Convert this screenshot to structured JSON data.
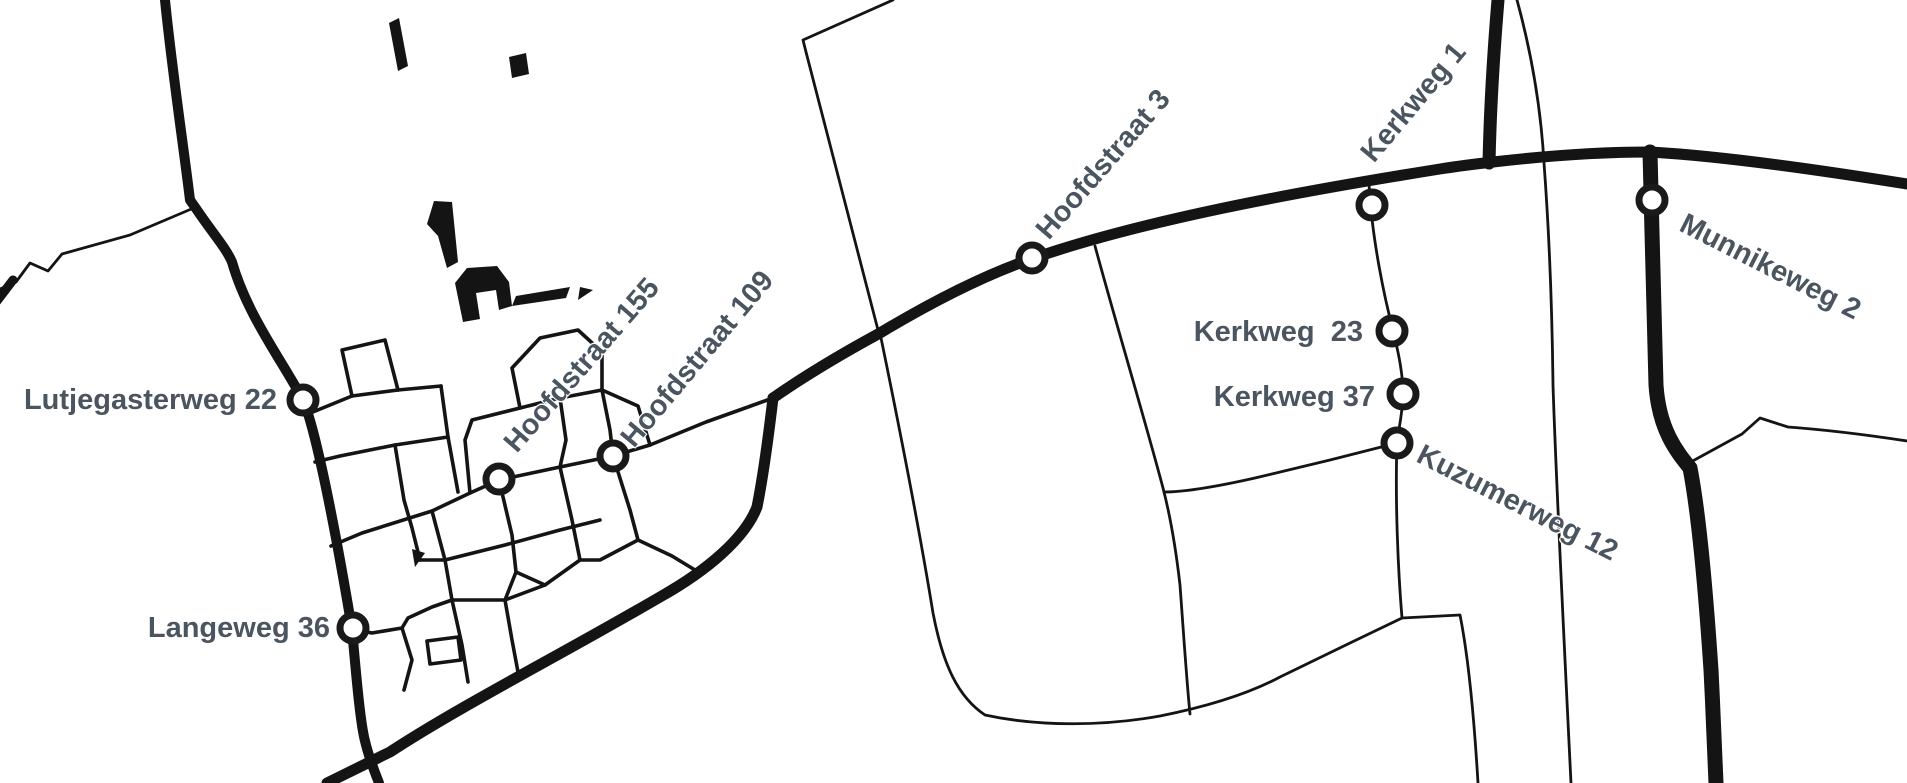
{
  "map": {
    "type": "monochrome-street-map",
    "background": "#ffffff",
    "road_color": "#141414",
    "label_color": "#4a5560",
    "marker_fill": "#ffffff",
    "marker_stroke": "#1a1a1a",
    "markers": [
      {
        "id": "lutjegasterweg-22",
        "label": "Lutjegasterweg 22",
        "x": 303,
        "y": 400,
        "label_rotation_deg": 0
      },
      {
        "id": "langeweg-36",
        "label": "Langeweg 36",
        "x": 353,
        "y": 628,
        "label_rotation_deg": 0
      },
      {
        "id": "hoofdstraat-155",
        "label": "Hoofdstraat 155",
        "x": 499,
        "y": 479,
        "label_rotation_deg": -49
      },
      {
        "id": "hoofdstraat-109",
        "label": "Hoofdstraat 109",
        "x": 613,
        "y": 456,
        "label_rotation_deg": -50
      },
      {
        "id": "hoofdstraat-3",
        "label": "Hoofdstraat 3",
        "x": 1032,
        "y": 258,
        "label_rotation_deg": -49
      },
      {
        "id": "kerkweg-1",
        "label": "Kerkweg 1",
        "x": 1372,
        "y": 205,
        "label_rotation_deg": -50
      },
      {
        "id": "kerkweg-23",
        "label": "Kerkweg  23",
        "x": 1392,
        "y": 331,
        "label_rotation_deg": 0
      },
      {
        "id": "kerkweg-37",
        "label": "Kerkweg 37",
        "x": 1403,
        "y": 394,
        "label_rotation_deg": 0
      },
      {
        "id": "kuzumerweg-12",
        "label": "Kuzumerweg 12",
        "x": 1397,
        "y": 443,
        "label_rotation_deg": 27
      },
      {
        "id": "munnikeweg-2",
        "label": "Munnikeweg 2",
        "x": 1652,
        "y": 200,
        "label_rotation_deg": 27
      }
    ]
  }
}
